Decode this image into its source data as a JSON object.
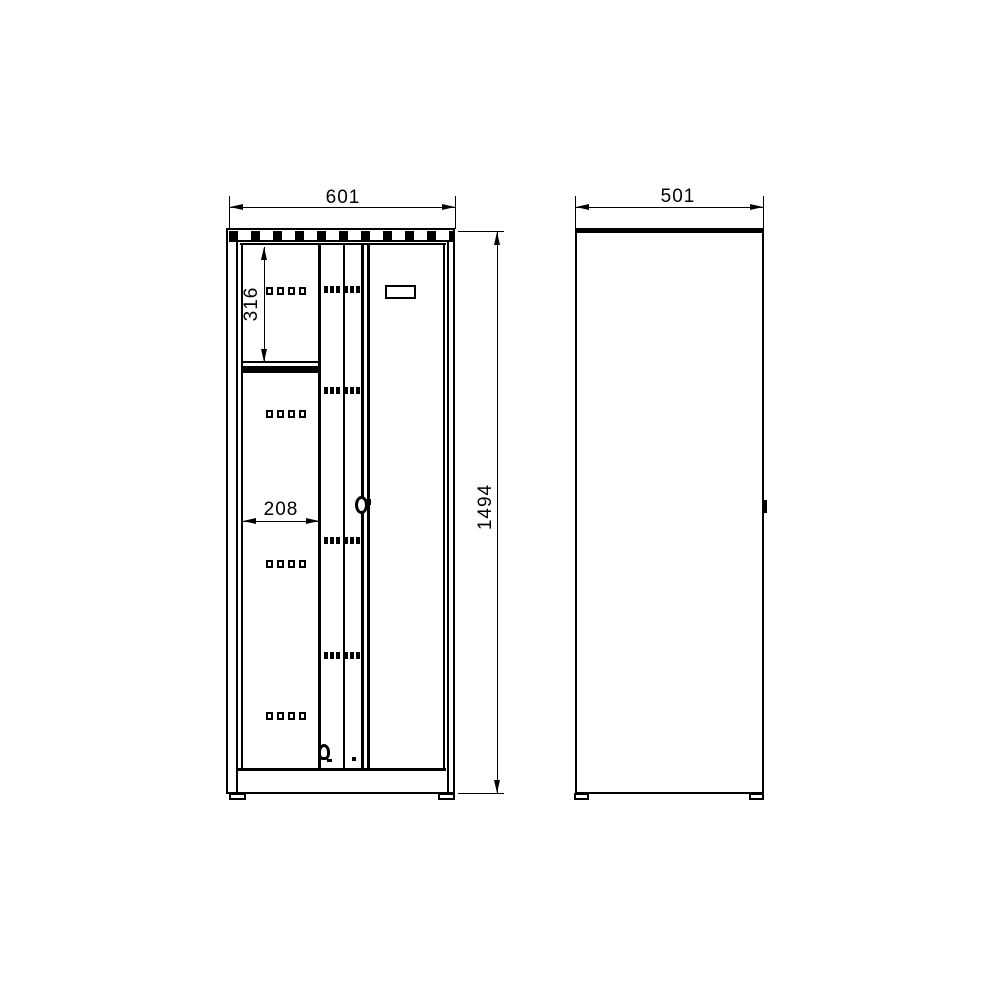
{
  "colors": {
    "background": "#ffffff",
    "line": "#000000"
  },
  "front_view": {
    "name": "cabinet front view",
    "width": "601",
    "height": "1494",
    "compartment_height": "316",
    "door_width": "208"
  },
  "side_view": {
    "name": "cabinet side view",
    "depth": "501"
  },
  "icons": {
    "cylinder_lock": "cylinder-lock-icon",
    "padlock_eye": "padlock-eye-icon",
    "rivet": "rivet-dot-icon",
    "vent_band": "louvre-vent-band",
    "perforations": "perforation-row",
    "vent_dashes": "vent-slot-strip"
  }
}
